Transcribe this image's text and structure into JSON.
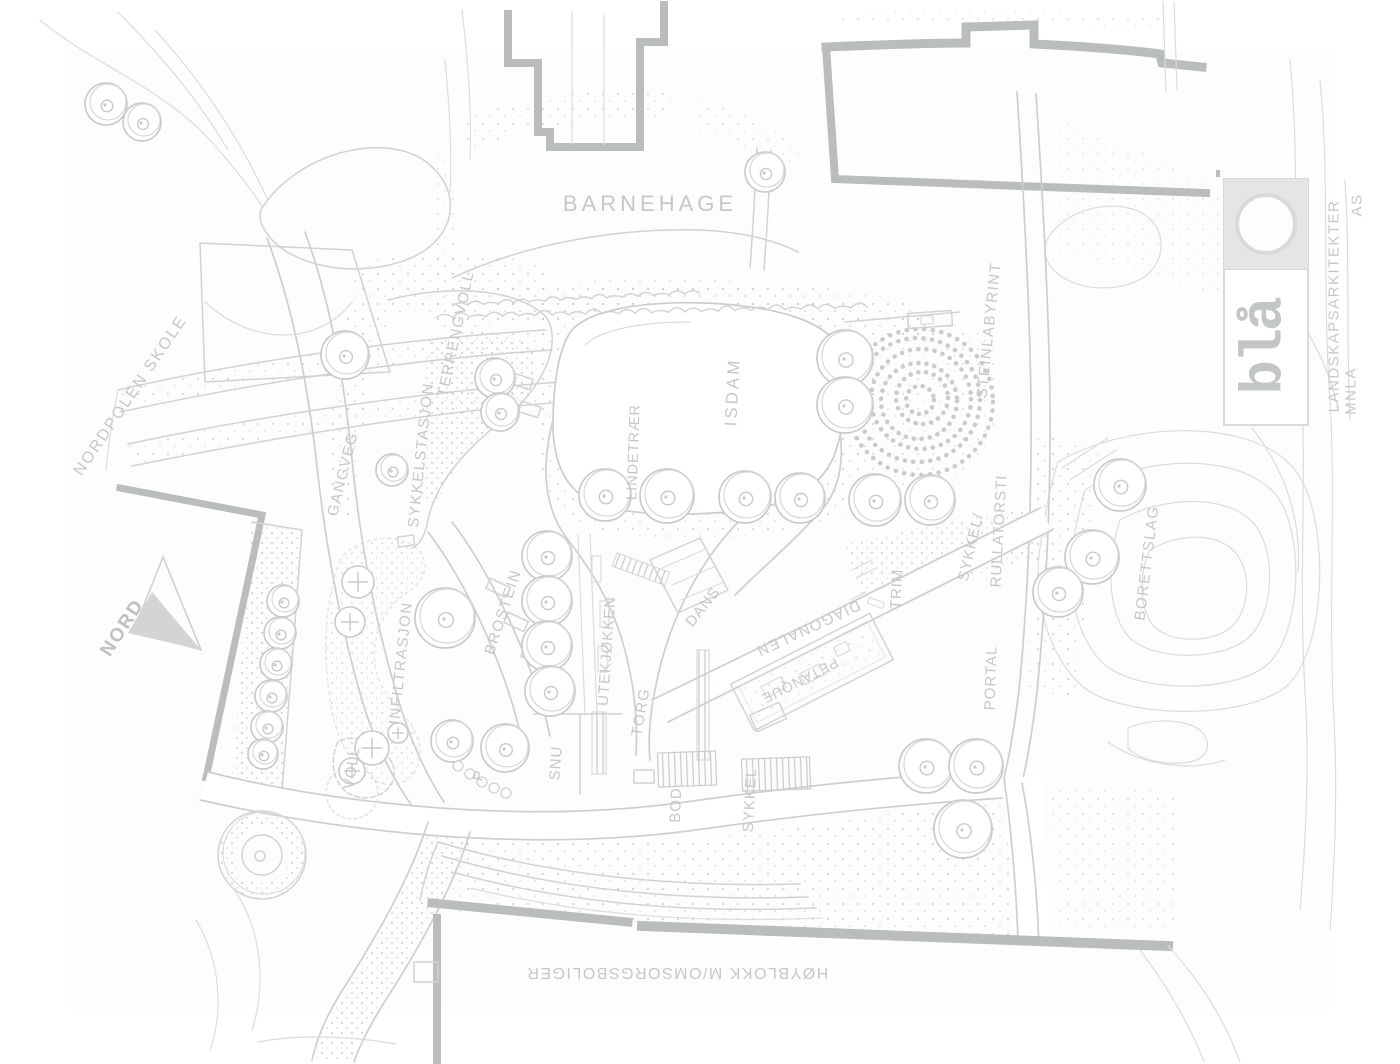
{
  "map": {
    "north_label": "NORD",
    "labels": [
      {
        "id": "nordpolen-skole",
        "text": "NORDPOLEN SKOLE"
      },
      {
        "id": "barnehage",
        "text": "BARNEHAGE"
      },
      {
        "id": "terrengvoll",
        "text": "TERRENGVOLL"
      },
      {
        "id": "sykkelstasjon",
        "text": "SYKKELSTASJON"
      },
      {
        "id": "gangveg",
        "text": "GANGVEG"
      },
      {
        "id": "isdam",
        "text": "ISDAM"
      },
      {
        "id": "lindetraer",
        "text": "LINDETRÆR"
      },
      {
        "id": "steinlabyrint",
        "text": "STEINLABYRINT"
      },
      {
        "id": "sykkel-sti",
        "text": "SYKKEL/"
      },
      {
        "id": "rullatorsti",
        "text": "RULLATORSTI"
      },
      {
        "id": "borettslag",
        "text": "BORETTSLAG"
      },
      {
        "id": "trim",
        "text": "TRIM"
      },
      {
        "id": "dans",
        "text": "DANS"
      },
      {
        "id": "diagonalen",
        "text": "DIAGONALEN"
      },
      {
        "id": "petanque",
        "text": "PETANQUE"
      },
      {
        "id": "portal",
        "text": "PORTAL"
      },
      {
        "id": "infiltrasjon",
        "text": "INFILTRASJON"
      },
      {
        "id": "brostein",
        "text": "BROSTEIN"
      },
      {
        "id": "utekjokken",
        "text": "UTEKJØKKEN"
      },
      {
        "id": "torg",
        "text": "TORG"
      },
      {
        "id": "voll",
        "text": "VOLL"
      },
      {
        "id": "parking",
        "text": "P"
      },
      {
        "id": "snu",
        "text": "SNU"
      },
      {
        "id": "bod",
        "text": "BOD"
      },
      {
        "id": "sykkel",
        "text": "SYKKEL"
      },
      {
        "id": "hoyblokk",
        "text": "HØYBLOKK M/OMSORGSBOLIGER"
      }
    ]
  },
  "logo": {
    "wordmark": "blå",
    "firm_line1": "LANDSKAPSARKITEKTER",
    "firm_line2": "MNLA",
    "firm_line3": "AS"
  },
  "colors": {
    "sketch_line": "#cfd4d3",
    "wall": "#b9bdbc",
    "label_text": "#c4c9c8",
    "logo_panel": "#e4e6e5"
  }
}
